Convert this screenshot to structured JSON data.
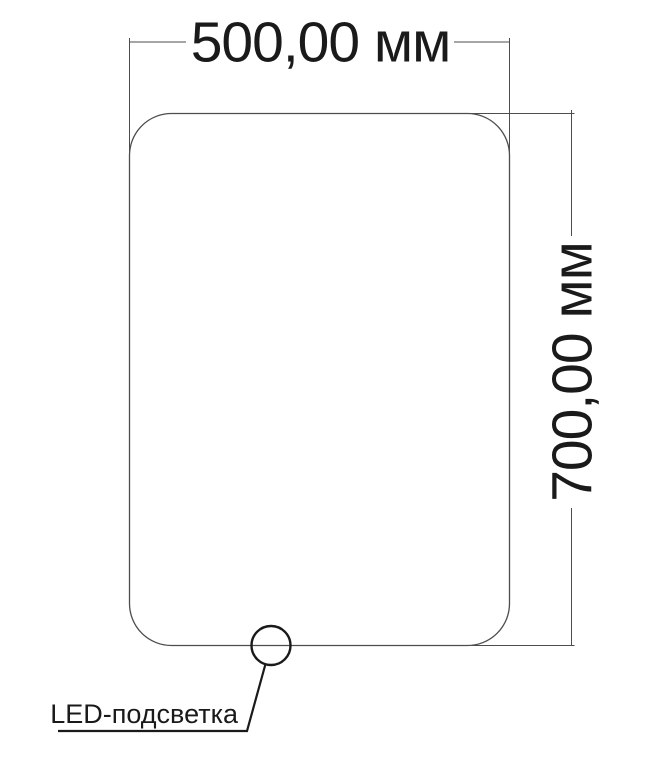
{
  "diagram": {
    "type": "technical-dimension-drawing",
    "subject": "mirror-with-led-backlight",
    "width_dimension": {
      "label": "500,00 мм",
      "value": "500,00",
      "unit": "мм"
    },
    "height_dimension": {
      "label": "700,00 мм",
      "value": "700,00",
      "unit": "мм"
    },
    "led_callout": {
      "label": "LED-подсветка"
    }
  },
  "colors": {
    "background": "#ffffff",
    "line": "#4d4d4d",
    "ink": "#1a1a1a"
  }
}
